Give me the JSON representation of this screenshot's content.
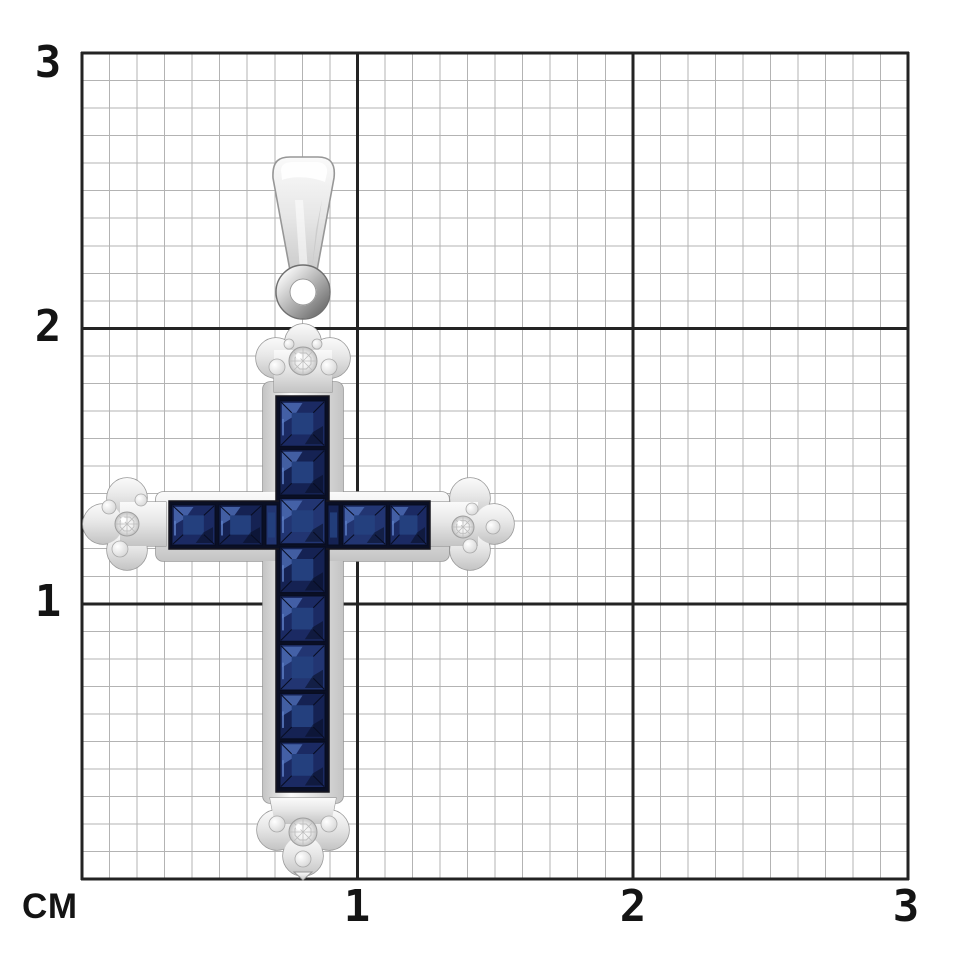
{
  "figure": {
    "kind": "jewelry product photo on centimeter measurement grid",
    "subject": "white-metal cross pendant with tapered bail and jump ring, channel-set square blue sapphires, round diamonds in trefoil tips"
  },
  "ruler": {
    "unit_label": "СМ",
    "x_ticks": [
      "1",
      "2",
      "3"
    ],
    "y_ticks": [
      "3",
      "2",
      "1"
    ],
    "cm_span": 3,
    "minor_divisions_per_cm": 10,
    "colors": {
      "background": "#ffffff",
      "minor_line": "#b3b3b3",
      "major_line": "#232323",
      "label": "#141414"
    }
  },
  "pendant": {
    "stones": {
      "sapphire_cut": "square",
      "vertical_rows": 8,
      "horizontal_left": 3,
      "horizontal_right": 3,
      "diamond_count": 4,
      "diamond_positions": [
        "top-trefoil",
        "left-trefoil",
        "right-trefoil",
        "bottom-trefoil"
      ]
    },
    "colors": {
      "sapphire_edge": "#080d22",
      "sapphire_face_a": "#1b2a63",
      "sapphire_face_b": "#152253",
      "sapphire_face_c": "#223572",
      "sapphire_table": "#24407e",
      "sapphire_light": "#4a69b0",
      "sapphire_glint": "#5b7cc4",
      "channel": "#0a0f24",
      "metal_hi": "#fafafa",
      "metal_mid": "#e7e7e7",
      "metal_lo": "#c4c4c4",
      "metal_edge": "#979797",
      "metal_dark": "#6f6f6f",
      "diamond_center": "#ffffff",
      "diamond_mid": "#ededed",
      "diamond_edge": "#c3c3c3",
      "diamond_line": "#bdbdbd"
    }
  }
}
